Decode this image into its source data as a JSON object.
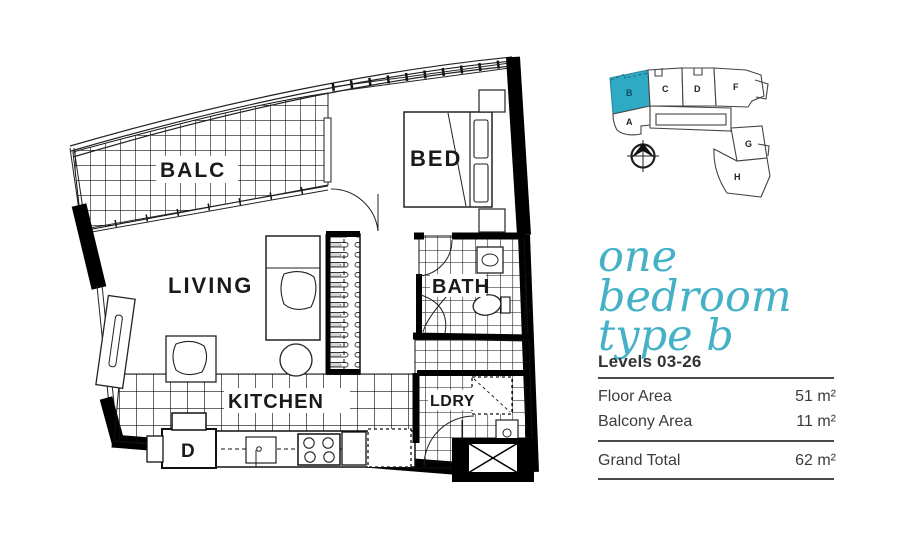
{
  "colors": {
    "accent_teal": "#2faac4",
    "title_teal": "#45b1c7",
    "plan_ink": "#111111"
  },
  "floorplan": {
    "rooms": {
      "balcony": "BALC",
      "bedroom": "BED",
      "living": "LIVING",
      "bathroom": "BATH",
      "kitchen": "KITCHEN",
      "laundry": "LDRY"
    },
    "appliances": {
      "dishwasher": "D"
    }
  },
  "keyplan": {
    "highlighted_unit": "B",
    "units": [
      {
        "id": "A"
      },
      {
        "id": "B"
      },
      {
        "id": "C"
      },
      {
        "id": "D"
      },
      {
        "id": "F"
      },
      {
        "id": "G"
      },
      {
        "id": "H"
      }
    ]
  },
  "details": {
    "title_line1": "one bedroom",
    "title_line2": "type b",
    "levels": "Levels 03-26",
    "areas": [
      {
        "label": "Floor Area",
        "value": "51 m²"
      },
      {
        "label": "Balcony Area",
        "value": "11 m²"
      }
    ],
    "total": {
      "label": "Grand Total",
      "value": "62 m²"
    }
  }
}
